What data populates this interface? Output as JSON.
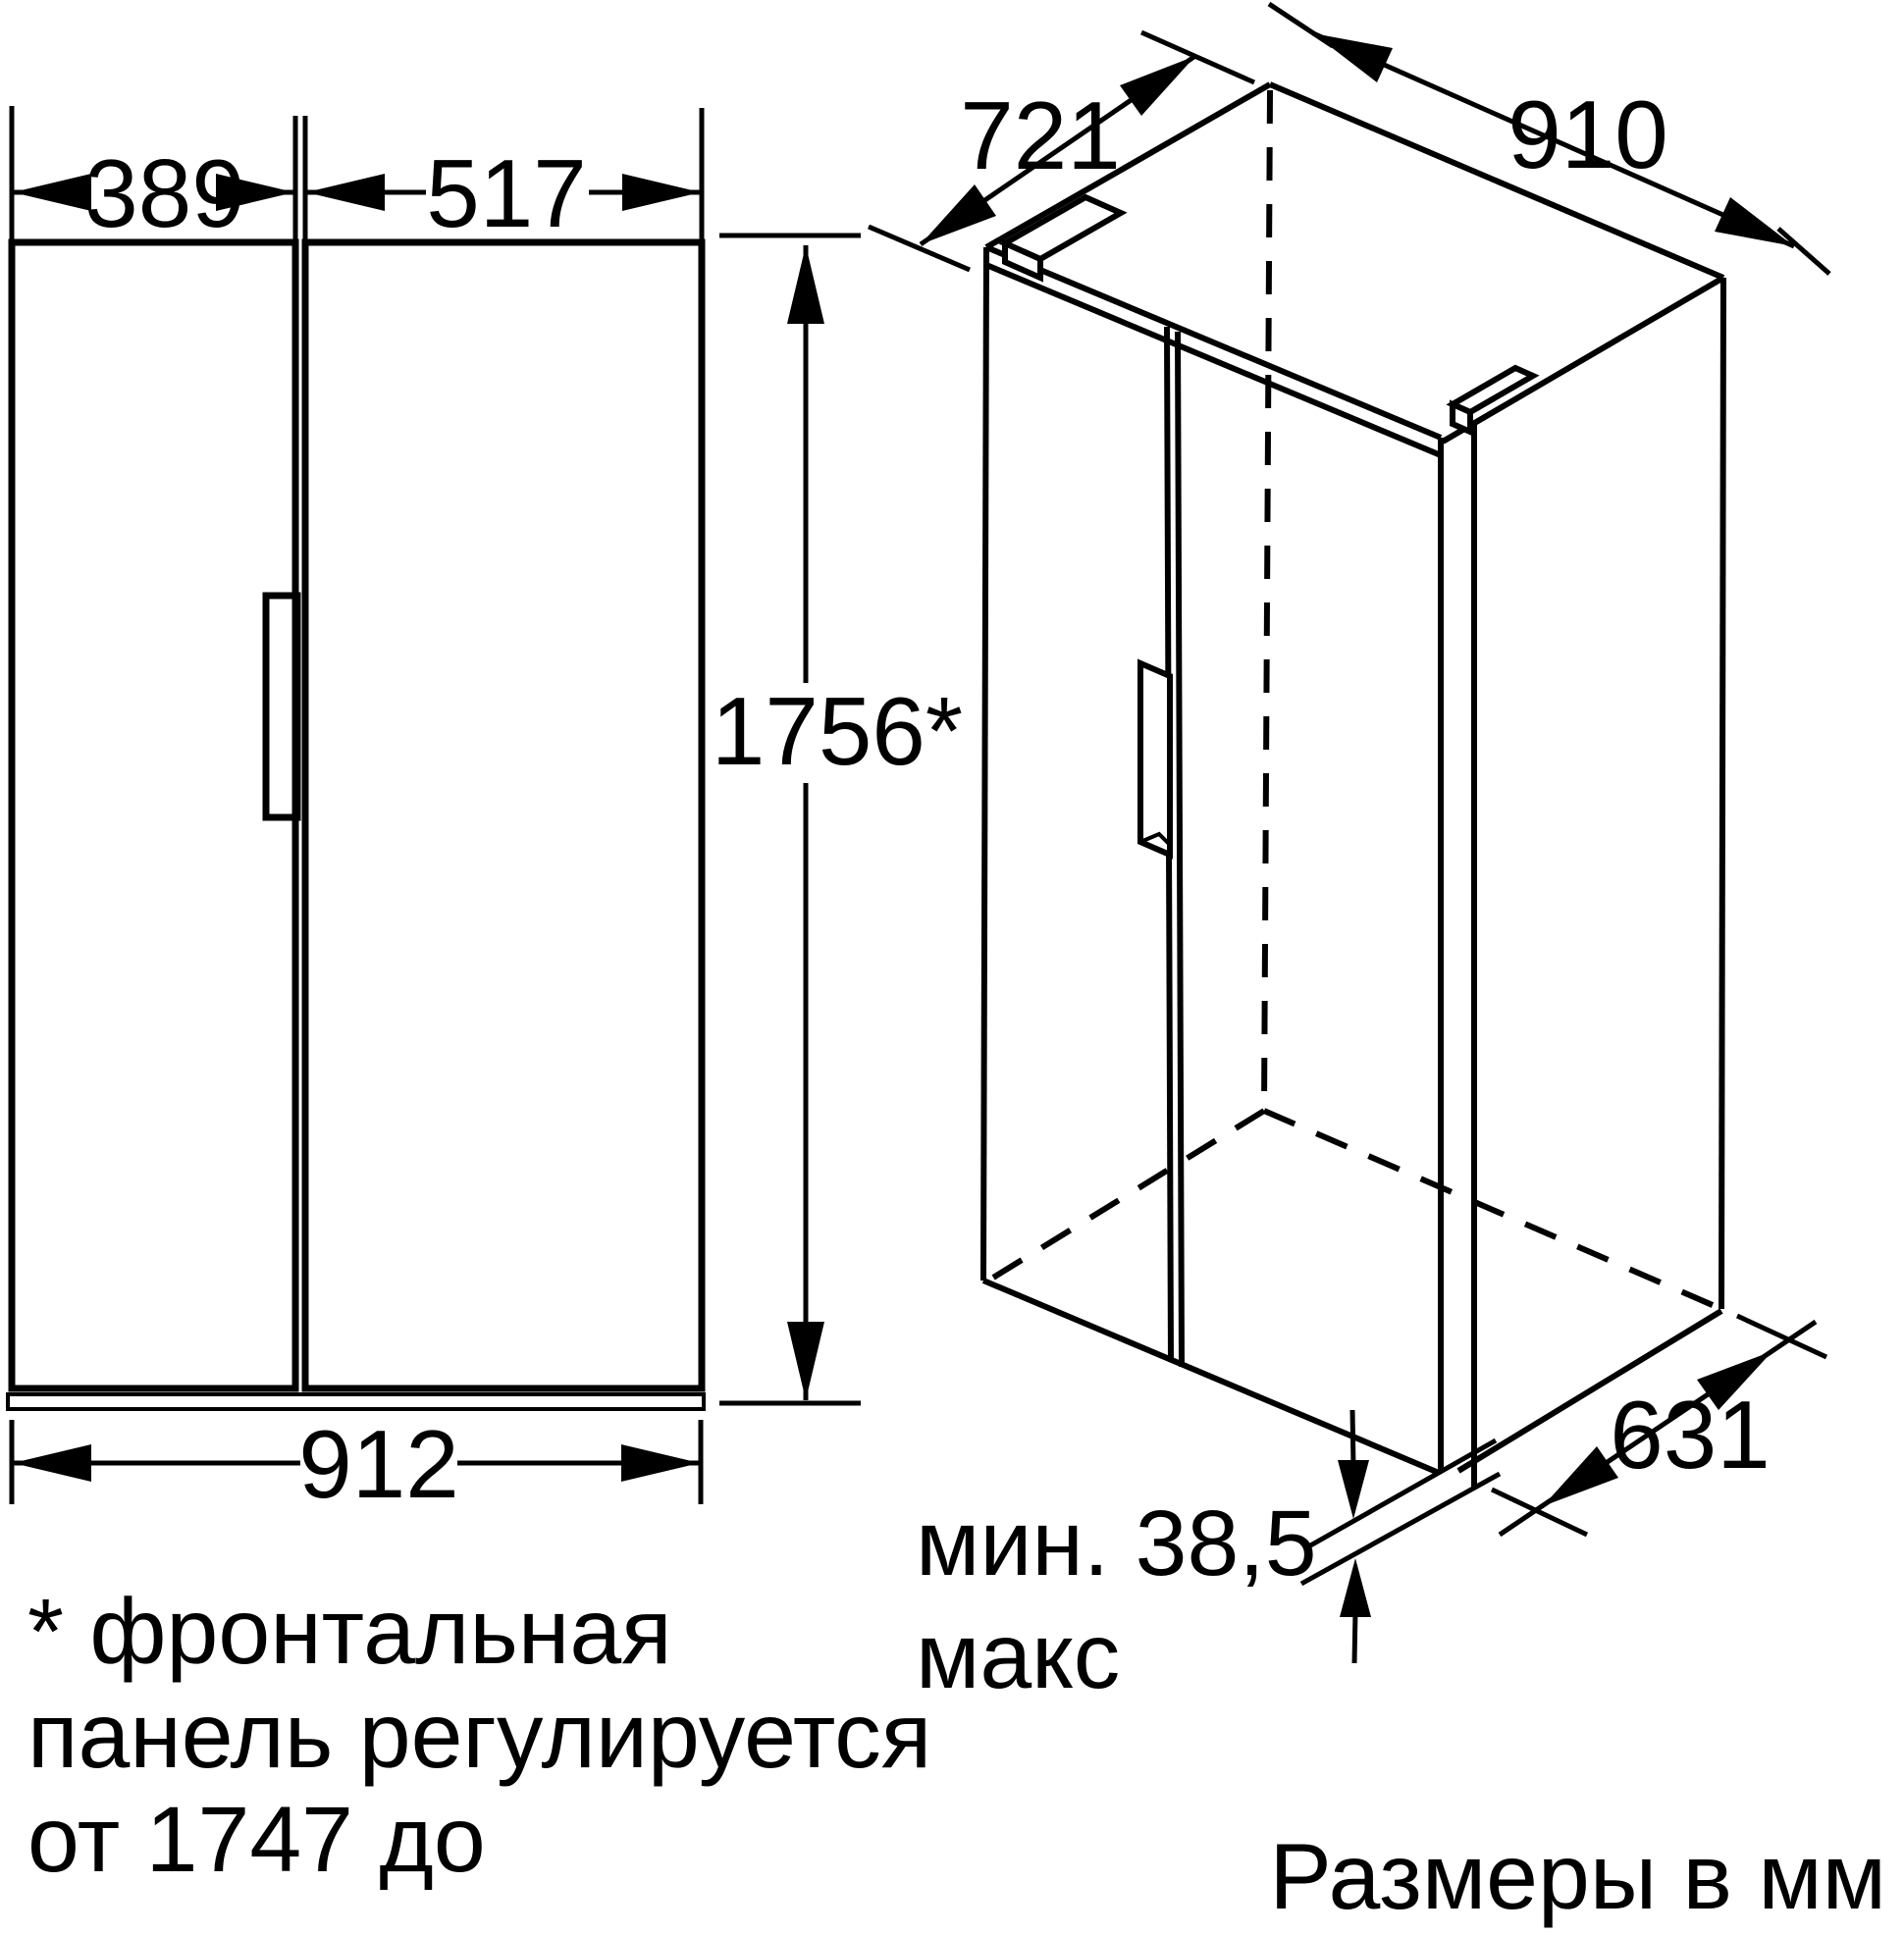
{
  "diagram": {
    "front_view": {
      "left_door_width_mm": "389",
      "right_door_width_mm": "517",
      "height_mm": "1756*",
      "total_width_mm": "912"
    },
    "perspective_view": {
      "top_depth_mm": "721",
      "top_width_mm": "910",
      "bottom_depth_mm": "631",
      "bottom_clearance_min": "мин. 38,5",
      "bottom_clearance_max": "макс"
    },
    "footnote": {
      "line1": "* фронтальная",
      "line2": "панель регулируется",
      "line3": "от 1747 до"
    },
    "units_note": "Размеры в мм",
    "colors": {
      "line": "#000000",
      "background": "#ffffff"
    }
  }
}
